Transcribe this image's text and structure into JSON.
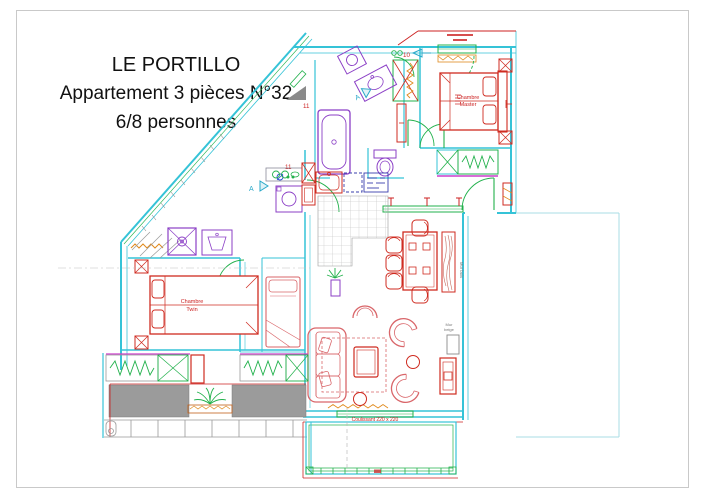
{
  "title": {
    "line1": "LE PORTILLO",
    "line2": "Appartement 3 pièces N°32",
    "line3": "6/8 personnes"
  },
  "rooms": {
    "master": {
      "line1": "Chambre",
      "line2": "Master"
    },
    "twin": {
      "line1": "Chambre",
      "line2": "Twin"
    }
  },
  "annotations": {
    "door_number_master": "10",
    "door_number_bathroom": "11",
    "door_number_hall": "11",
    "section_marker_1": "A",
    "section_marker_2": "A",
    "sliding_door": "Coulissant 220 x 220",
    "wall_note_beige_line1": "Mur",
    "wall_note_beige_line2": "beige",
    "wall_note_wood": "Mur bois"
  },
  "palette": {
    "wall_cyan": "#35c3d7",
    "door_window_green": "#22b14c",
    "furniture_red": "#cf2b20",
    "soft_furniture_pink": "#d9666a",
    "sanitary_purple": "#8b3fc6",
    "magenta": "#cc3fcc",
    "orange": "#e08a1e",
    "wall_gray_fill": "#9b9b9b",
    "appliance_blue": "#3a3fae",
    "annotation_red": "#cc2222",
    "page_border_gray": "#c9c9c9"
  }
}
